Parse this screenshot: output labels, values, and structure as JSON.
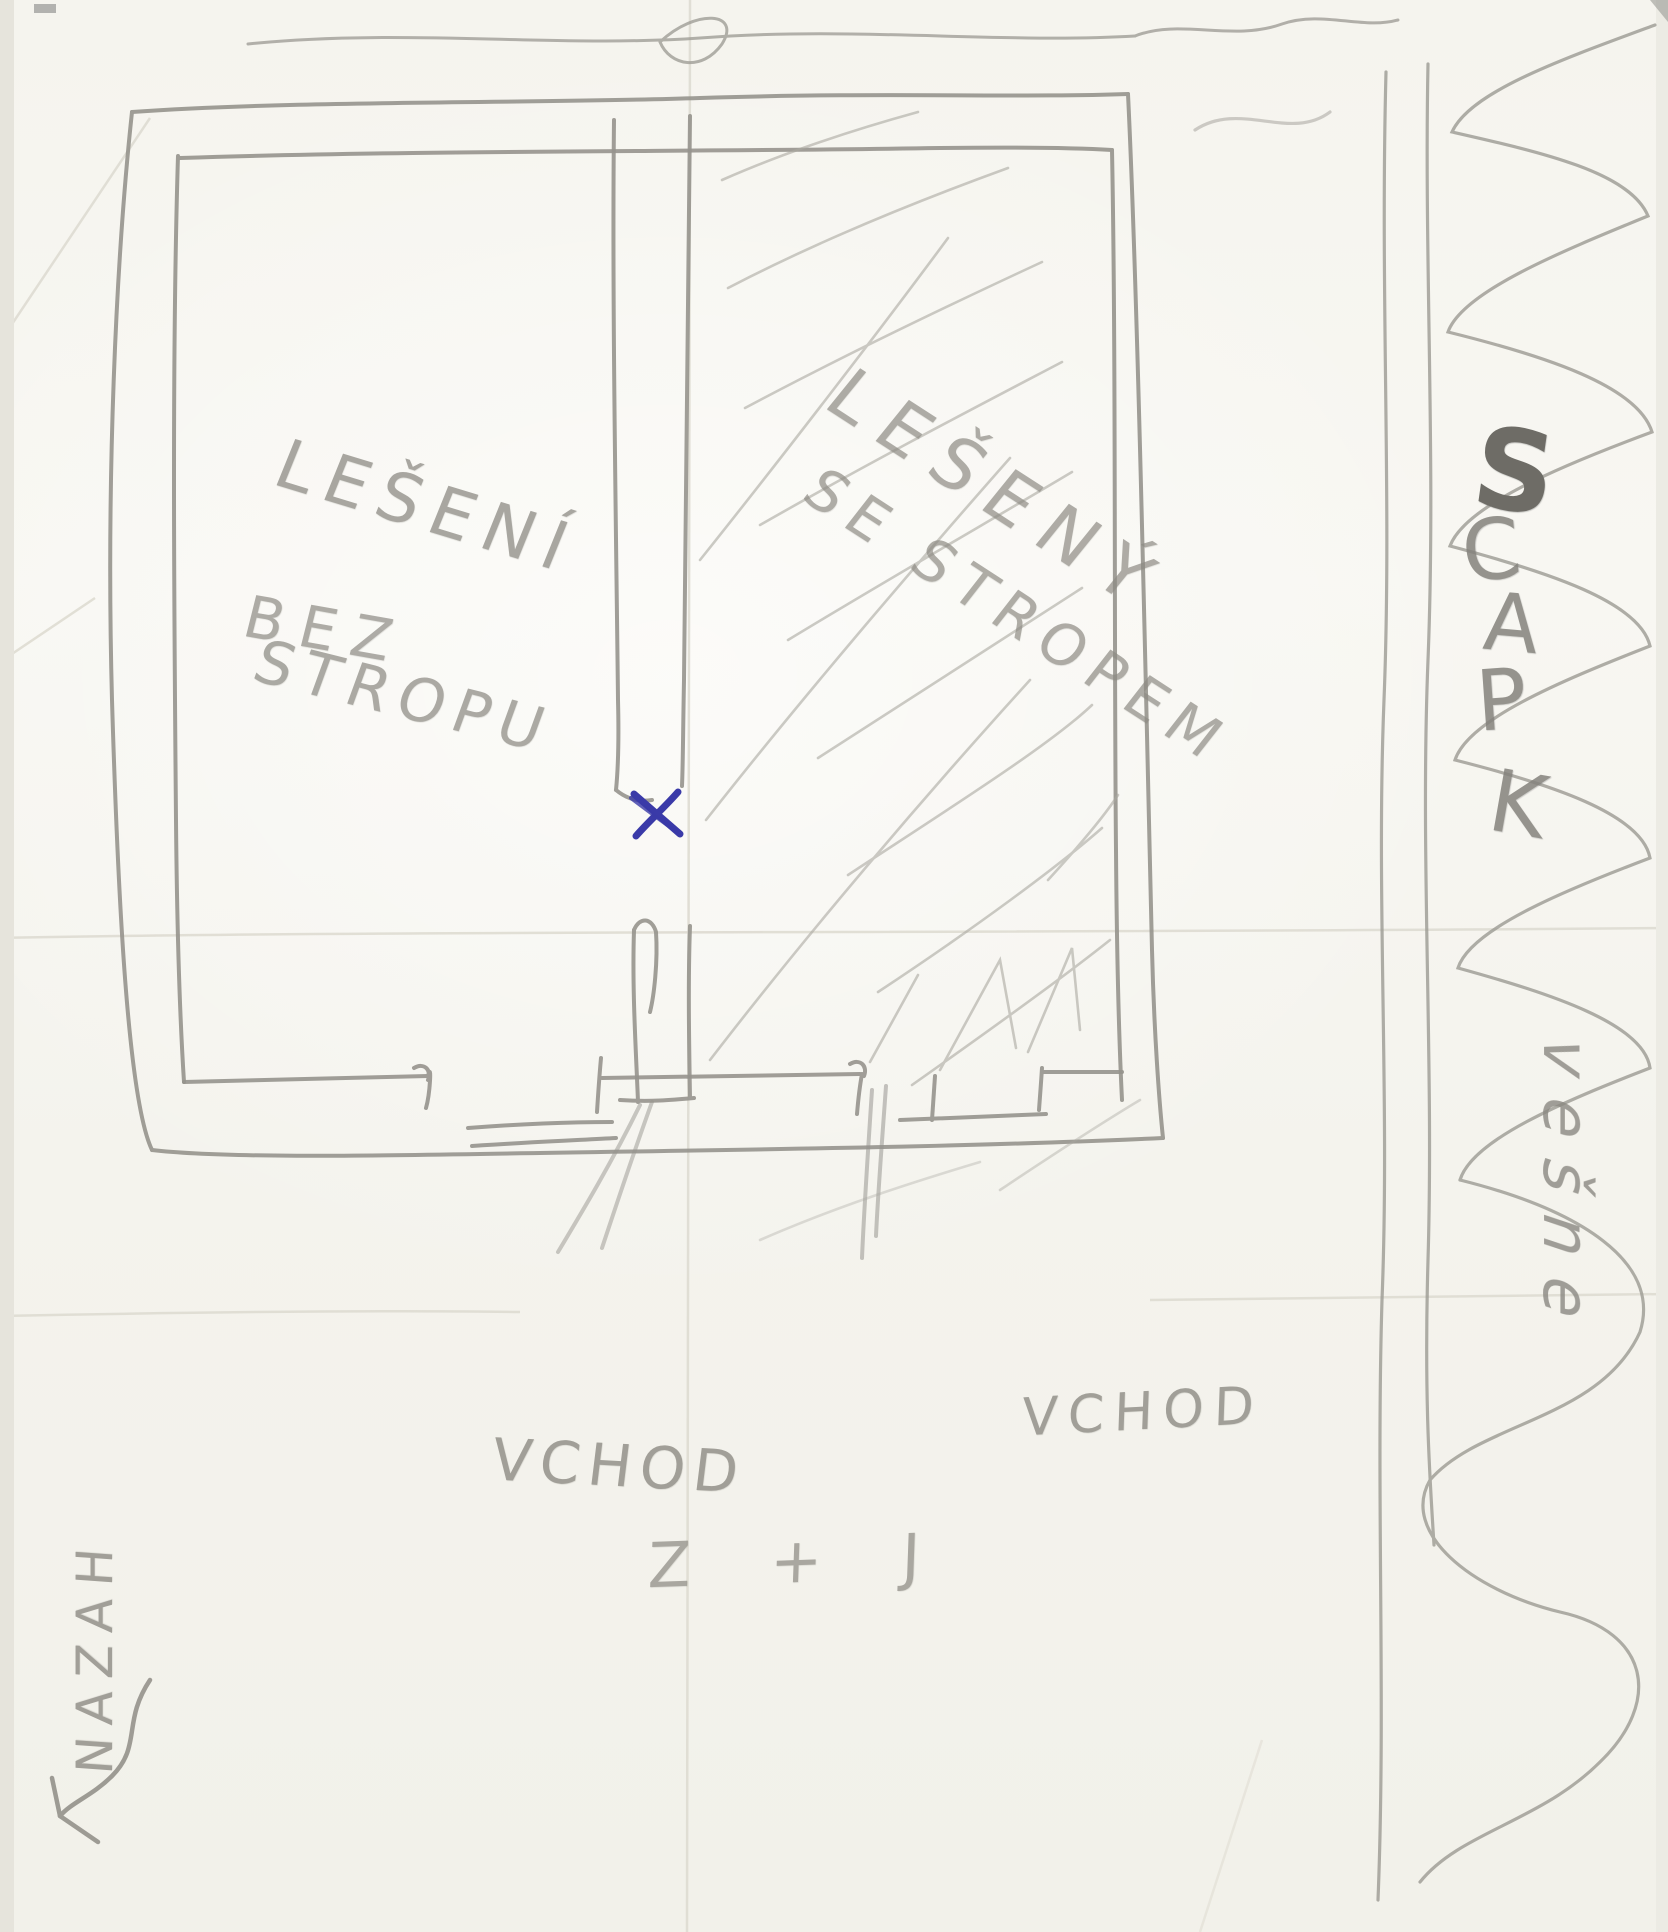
{
  "paper": {
    "background_color": "#f7f6f1",
    "pencil_color": "#908e87",
    "blue_ink_color": "#3a3aa8"
  },
  "rooms": {
    "left": {
      "label_lines": [
        "LEŠENÍ",
        "BEZ",
        "STROPU"
      ]
    },
    "right": {
      "label_lines": [
        "LEŠENÝ",
        "SE STROPEM"
      ]
    }
  },
  "entrances": {
    "left_label": "VCHOD",
    "right_label": "VCHOD"
  },
  "bottom_note": "Z + J",
  "left_margin_vertical_text": "NAZAH",
  "right_margin": {
    "letters": [
      "S",
      "C",
      "A",
      "P",
      "K"
    ],
    "cursive_text": "vešne"
  }
}
